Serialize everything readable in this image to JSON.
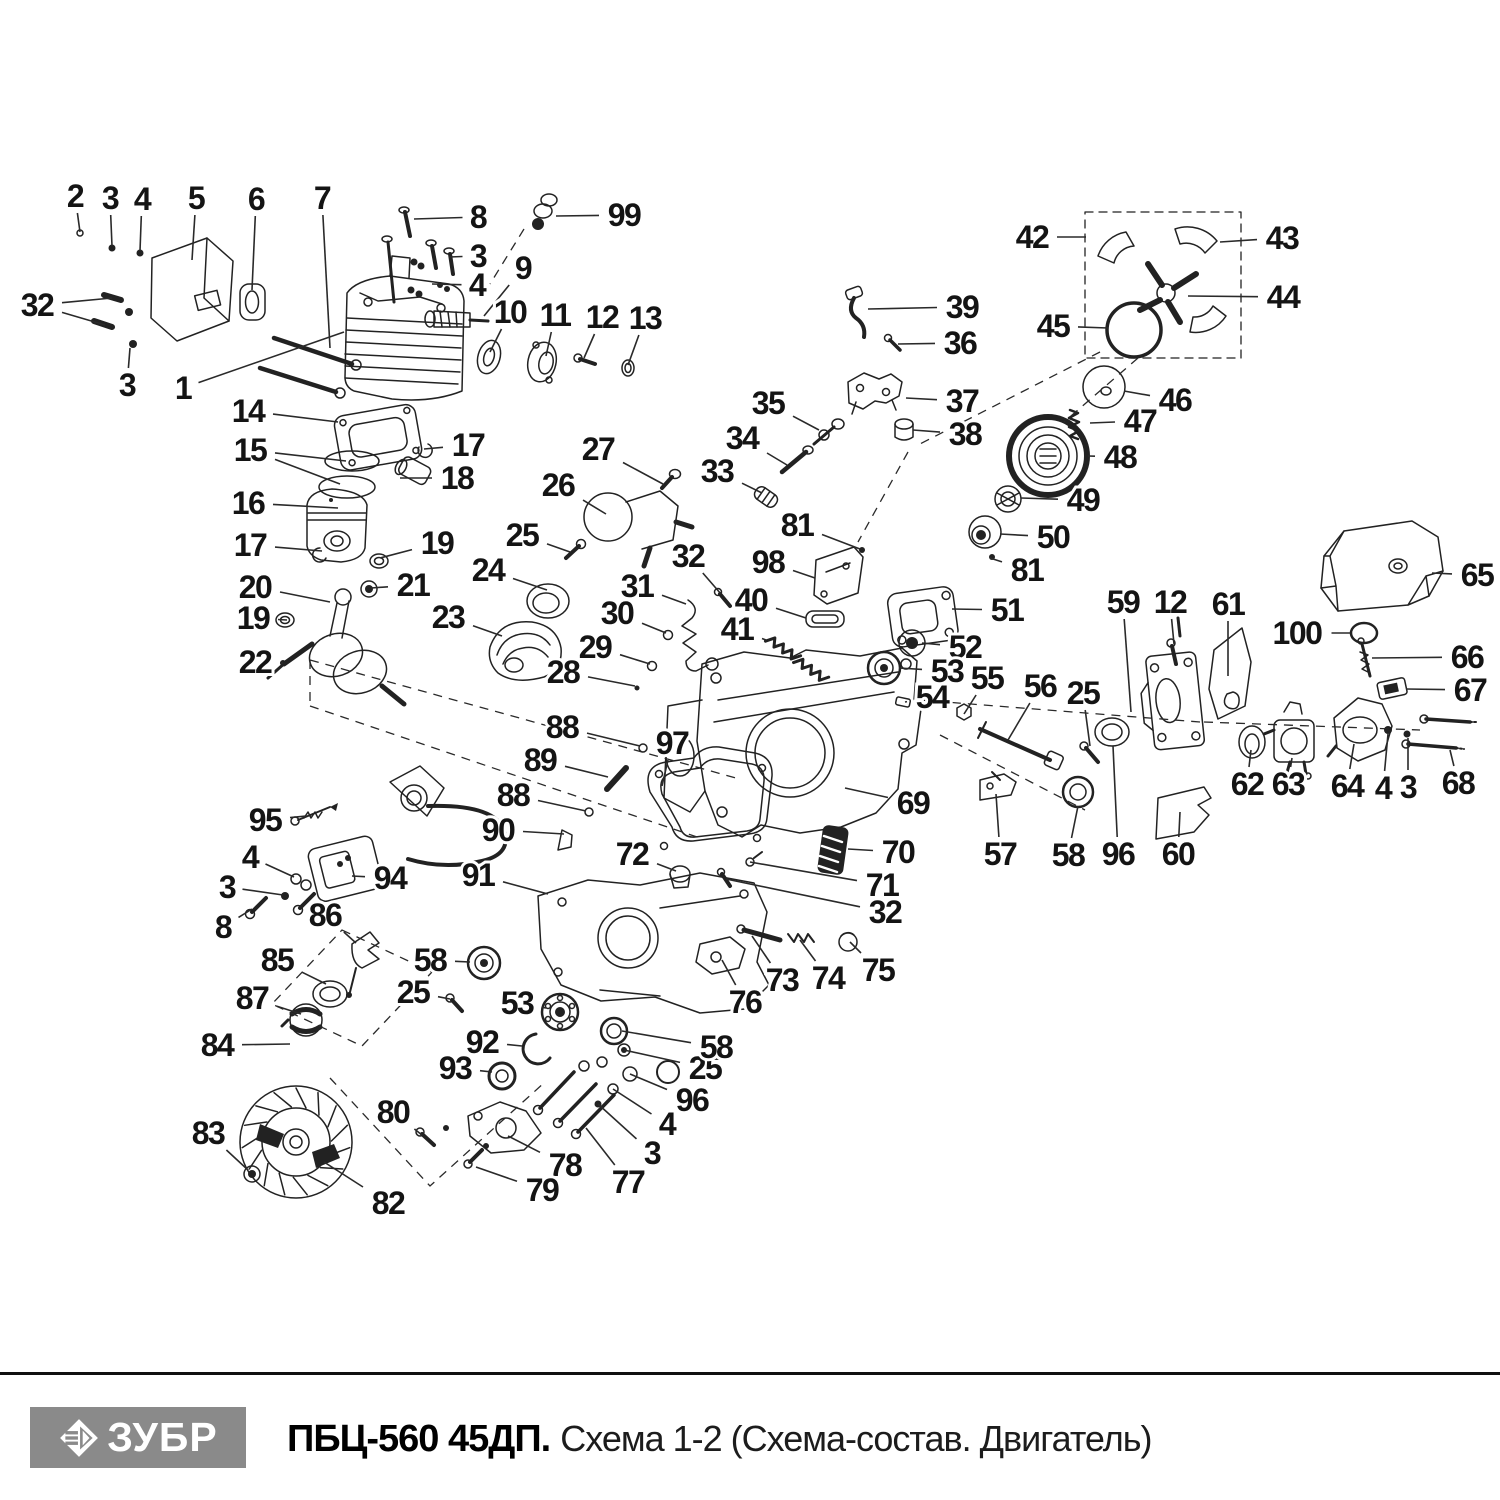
{
  "footer": {
    "brand": "ЗУБР",
    "title_bold": "ПБЦ-560 45ДП.",
    "title_regular": "Схема 1-2 (Схема-состав. Двигатель)",
    "brand_bg": "#8a8a8a",
    "rule_color": "#101010"
  },
  "diagram": {
    "ink": "#222222",
    "labels": [
      {
        "t": "2",
        "x": 75,
        "y": 196,
        "to": [
          [
            80,
            232
          ]
        ]
      },
      {
        "t": "3",
        "x": 110,
        "y": 198,
        "to": [
          [
            112,
            246
          ]
        ]
      },
      {
        "t": "4",
        "x": 142,
        "y": 199,
        "to": [
          [
            140,
            251
          ]
        ]
      },
      {
        "t": "5",
        "x": 196,
        "y": 198,
        "to": [
          [
            192,
            260
          ]
        ]
      },
      {
        "t": "6",
        "x": 256,
        "y": 199,
        "to": [
          [
            252,
            290
          ]
        ]
      },
      {
        "t": "7",
        "x": 322,
        "y": 198,
        "to": [
          [
            330,
            348
          ]
        ]
      },
      {
        "t": "8",
        "x": 478,
        "y": 217,
        "to": [
          [
            414,
            219
          ]
        ]
      },
      {
        "t": "99",
        "x": 624,
        "y": 215,
        "to": [
          [
            556,
            216
          ]
        ]
      },
      {
        "t": "3",
        "x": 478,
        "y": 256,
        "to": [
          [
            449,
            257
          ]
        ]
      },
      {
        "t": "4",
        "x": 477,
        "y": 285,
        "to": [
          [
            432,
            284
          ]
        ]
      },
      {
        "t": "9",
        "x": 523,
        "y": 268,
        "to": [
          [
            484,
            316
          ]
        ]
      },
      {
        "t": "10",
        "x": 510,
        "y": 312,
        "to": [
          [
            490,
            352
          ]
        ]
      },
      {
        "t": "11",
        "x": 555,
        "y": 315,
        "to": [
          [
            546,
            356
          ]
        ]
      },
      {
        "t": "12",
        "x": 602,
        "y": 317,
        "to": [
          [
            584,
            358
          ]
        ]
      },
      {
        "t": "13",
        "x": 645,
        "y": 318,
        "to": [
          [
            628,
            365
          ]
        ]
      },
      {
        "t": "32",
        "x": 37,
        "y": 305,
        "to": [
          [
            112,
            298
          ],
          [
            105,
            325
          ]
        ]
      },
      {
        "t": "3",
        "x": 127,
        "y": 385,
        "to": [
          [
            130,
            348
          ]
        ]
      },
      {
        "t": "1",
        "x": 183,
        "y": 388,
        "to": [
          [
            344,
            332
          ]
        ]
      },
      {
        "t": "14",
        "x": 248,
        "y": 411,
        "to": [
          [
            338,
            422
          ]
        ]
      },
      {
        "t": "15",
        "x": 250,
        "y": 450,
        "to": [
          [
            346,
            461
          ],
          [
            340,
            484
          ]
        ]
      },
      {
        "t": "17",
        "x": 468,
        "y": 445,
        "to": [
          [
            424,
            449
          ]
        ]
      },
      {
        "t": "18",
        "x": 457,
        "y": 478,
        "to": [
          [
            400,
            478
          ]
        ]
      },
      {
        "t": "16",
        "x": 248,
        "y": 503,
        "to": [
          [
            338,
            508
          ]
        ]
      },
      {
        "t": "17",
        "x": 250,
        "y": 545,
        "to": [
          [
            322,
            551
          ]
        ]
      },
      {
        "t": "19",
        "x": 437,
        "y": 543,
        "to": [
          [
            380,
            558
          ]
        ]
      },
      {
        "t": "20",
        "x": 255,
        "y": 587,
        "to": [
          [
            330,
            602
          ]
        ]
      },
      {
        "t": "21",
        "x": 413,
        "y": 585,
        "to": [
          [
            371,
            588
          ]
        ]
      },
      {
        "t": "19",
        "x": 253,
        "y": 618,
        "to": [
          [
            287,
            620
          ]
        ]
      },
      {
        "t": "22",
        "x": 255,
        "y": 662,
        "to": [
          [
            283,
            663
          ]
        ]
      },
      {
        "t": "23",
        "x": 448,
        "y": 617,
        "to": [
          [
            502,
            636
          ]
        ]
      },
      {
        "t": "24",
        "x": 488,
        "y": 570,
        "to": [
          [
            547,
            590
          ]
        ]
      },
      {
        "t": "25",
        "x": 522,
        "y": 535,
        "to": [
          [
            570,
            552
          ]
        ]
      },
      {
        "t": "26",
        "x": 558,
        "y": 485,
        "to": [
          [
            606,
            514
          ]
        ]
      },
      {
        "t": "27",
        "x": 598,
        "y": 449,
        "to": [
          [
            663,
            484
          ]
        ]
      },
      {
        "t": "28",
        "x": 563,
        "y": 672,
        "to": [
          [
            635,
            686
          ]
        ]
      },
      {
        "t": "29",
        "x": 595,
        "y": 647,
        "to": [
          [
            650,
            664
          ]
        ]
      },
      {
        "t": "30",
        "x": 617,
        "y": 613,
        "to": [
          [
            666,
            633
          ]
        ]
      },
      {
        "t": "31",
        "x": 637,
        "y": 586,
        "to": [
          [
            686,
            604
          ]
        ]
      },
      {
        "t": "32",
        "x": 688,
        "y": 556,
        "to": [
          [
            721,
            594
          ]
        ]
      },
      {
        "t": "33",
        "x": 717,
        "y": 471,
        "to": [
          [
            762,
            493
          ]
        ]
      },
      {
        "t": "34",
        "x": 742,
        "y": 438,
        "to": [
          [
            787,
            465
          ]
        ]
      },
      {
        "t": "35",
        "x": 768,
        "y": 403,
        "to": [
          [
            819,
            430
          ]
        ]
      },
      {
        "t": "36",
        "x": 960,
        "y": 343,
        "to": [
          [
            898,
            344
          ]
        ]
      },
      {
        "t": "37",
        "x": 962,
        "y": 401,
        "to": [
          [
            906,
            398
          ]
        ]
      },
      {
        "t": "38",
        "x": 965,
        "y": 434,
        "to": [
          [
            913,
            430
          ]
        ]
      },
      {
        "t": "39",
        "x": 962,
        "y": 307,
        "to": [
          [
            868,
            309
          ]
        ]
      },
      {
        "t": "40",
        "x": 751,
        "y": 600,
        "to": [
          [
            806,
            618
          ]
        ]
      },
      {
        "t": "41",
        "x": 737,
        "y": 629,
        "to": [
          [
            766,
            640
          ]
        ]
      },
      {
        "t": "42",
        "x": 1032,
        "y": 237,
        "to": [
          [
            1086,
            237
          ]
        ]
      },
      {
        "t": "43",
        "x": 1282,
        "y": 238,
        "to": [
          [
            1220,
            242
          ]
        ]
      },
      {
        "t": "44",
        "x": 1283,
        "y": 297,
        "to": [
          [
            1188,
            296
          ]
        ]
      },
      {
        "t": "45",
        "x": 1053,
        "y": 326,
        "to": [
          [
            1108,
            328
          ]
        ]
      },
      {
        "t": "46",
        "x": 1175,
        "y": 400,
        "to": [
          [
            1124,
            391
          ]
        ]
      },
      {
        "t": "47",
        "x": 1140,
        "y": 421,
        "to": [
          [
            1090,
            423
          ]
        ]
      },
      {
        "t": "48",
        "x": 1120,
        "y": 457,
        "to": [
          [
            1088,
            456
          ]
        ]
      },
      {
        "t": "49",
        "x": 1083,
        "y": 500,
        "to": [
          [
            1021,
            498
          ]
        ]
      },
      {
        "t": "50",
        "x": 1053,
        "y": 537,
        "to": [
          [
            1000,
            534
          ]
        ]
      },
      {
        "t": "81",
        "x": 797,
        "y": 525,
        "to": [
          [
            860,
            549
          ]
        ]
      },
      {
        "t": "81",
        "x": 1027,
        "y": 570,
        "to": [
          [
            990,
            558
          ]
        ]
      },
      {
        "t": "98",
        "x": 768,
        "y": 562,
        "to": [
          [
            815,
            578
          ]
        ]
      },
      {
        "t": "51",
        "x": 1007,
        "y": 610,
        "to": [
          [
            952,
            609
          ]
        ]
      },
      {
        "t": "52",
        "x": 965,
        "y": 647,
        "to": [
          [
            922,
            643
          ]
        ]
      },
      {
        "t": "53",
        "x": 947,
        "y": 671,
        "to": [
          [
            899,
            668
          ]
        ]
      },
      {
        "t": "54",
        "x": 932,
        "y": 697,
        "to": [
          [
            905,
            702
          ]
        ]
      },
      {
        "t": "55",
        "x": 987,
        "y": 678,
        "to": [
          [
            964,
            714
          ]
        ]
      },
      {
        "t": "56",
        "x": 1040,
        "y": 686,
        "to": [
          [
            1008,
            740
          ]
        ]
      },
      {
        "t": "59",
        "x": 1123,
        "y": 602,
        "to": [
          [
            1131,
            712
          ]
        ]
      },
      {
        "t": "12",
        "x": 1170,
        "y": 602,
        "to": [
          [
            1174,
            644
          ]
        ]
      },
      {
        "t": "61",
        "x": 1228,
        "y": 604,
        "to": [
          [
            1228,
            676
          ]
        ]
      },
      {
        "t": "65",
        "x": 1477,
        "y": 575,
        "to": [
          [
            1432,
            573
          ]
        ]
      },
      {
        "t": "100",
        "x": 1297,
        "y": 633,
        "to": [
          [
            1350,
            633
          ]
        ]
      },
      {
        "t": "66",
        "x": 1467,
        "y": 657,
        "to": [
          [
            1372,
            658
          ]
        ]
      },
      {
        "t": "67",
        "x": 1470,
        "y": 690,
        "to": [
          [
            1406,
            689
          ]
        ]
      },
      {
        "t": "25",
        "x": 1083,
        "y": 693,
        "to": [
          [
            1090,
            746
          ]
        ]
      },
      {
        "t": "62",
        "x": 1247,
        "y": 784,
        "to": [
          [
            1251,
            750
          ]
        ]
      },
      {
        "t": "63",
        "x": 1288,
        "y": 784,
        "to": [
          [
            1292,
            758
          ]
        ]
      },
      {
        "t": "64",
        "x": 1347,
        "y": 786,
        "to": [
          [
            1354,
            744
          ]
        ]
      },
      {
        "t": "4",
        "x": 1383,
        "y": 788,
        "to": [
          [
            1388,
            734
          ]
        ]
      },
      {
        "t": "3",
        "x": 1408,
        "y": 787,
        "to": [
          [
            1408,
            738
          ]
        ]
      },
      {
        "t": "68",
        "x": 1458,
        "y": 783,
        "to": [
          [
            1450,
            750
          ]
        ]
      },
      {
        "t": "57",
        "x": 1000,
        "y": 854,
        "to": [
          [
            996,
            794
          ]
        ]
      },
      {
        "t": "58",
        "x": 1068,
        "y": 855,
        "to": [
          [
            1078,
            806
          ]
        ]
      },
      {
        "t": "96",
        "x": 1118,
        "y": 854,
        "to": [
          [
            1113,
            746
          ]
        ]
      },
      {
        "t": "60",
        "x": 1178,
        "y": 854,
        "to": [
          [
            1180,
            812
          ]
        ]
      },
      {
        "t": "69",
        "x": 913,
        "y": 803,
        "to": [
          [
            845,
            788
          ]
        ]
      },
      {
        "t": "70",
        "x": 898,
        "y": 852,
        "to": [
          [
            848,
            849
          ]
        ]
      },
      {
        "t": "71",
        "x": 882,
        "y": 885,
        "to": [
          [
            750,
            862
          ]
        ]
      },
      {
        "t": "32",
        "x": 885,
        "y": 912,
        "to": [
          [
            726,
            879
          ]
        ]
      },
      {
        "t": "72",
        "x": 632,
        "y": 854,
        "to": [
          [
            676,
            871
          ]
        ]
      },
      {
        "t": "88",
        "x": 562,
        "y": 727,
        "to": [
          [
            640,
            746
          ]
        ]
      },
      {
        "t": "97",
        "x": 672,
        "y": 743,
        "to": [
          [
            662,
            786
          ]
        ]
      },
      {
        "t": "89",
        "x": 540,
        "y": 760,
        "to": [
          [
            608,
            777
          ]
        ]
      },
      {
        "t": "88",
        "x": 513,
        "y": 795,
        "to": [
          [
            586,
            811
          ]
        ]
      },
      {
        "t": "90",
        "x": 498,
        "y": 830,
        "to": [
          [
            564,
            834
          ]
        ]
      },
      {
        "t": "95",
        "x": 265,
        "y": 820,
        "to": [
          [
            306,
            816
          ]
        ]
      },
      {
        "t": "4",
        "x": 250,
        "y": 857,
        "to": [
          [
            294,
            877
          ]
        ]
      },
      {
        "t": "3",
        "x": 227,
        "y": 887,
        "to": [
          [
            283,
            895
          ]
        ]
      },
      {
        "t": "8",
        "x": 223,
        "y": 927,
        "to": [
          [
            252,
            909
          ]
        ]
      },
      {
        "t": "94",
        "x": 390,
        "y": 878,
        "to": [
          [
            352,
            876
          ]
        ]
      },
      {
        "t": "86",
        "x": 325,
        "y": 915,
        "to": [
          [
            356,
            943
          ]
        ]
      },
      {
        "t": "85",
        "x": 277,
        "y": 960,
        "to": [
          [
            326,
            984
          ]
        ]
      },
      {
        "t": "87",
        "x": 252,
        "y": 998,
        "to": [
          [
            301,
            1014
          ]
        ]
      },
      {
        "t": "84",
        "x": 217,
        "y": 1045,
        "to": [
          [
            290,
            1044
          ]
        ]
      },
      {
        "t": "91",
        "x": 478,
        "y": 875,
        "to": [
          [
            548,
            894
          ]
        ]
      },
      {
        "t": "73",
        "x": 782,
        "y": 980,
        "to": [
          [
            752,
            936
          ]
        ]
      },
      {
        "t": "74",
        "x": 828,
        "y": 978,
        "to": [
          [
            800,
            940
          ]
        ]
      },
      {
        "t": "75",
        "x": 878,
        "y": 970,
        "to": [
          [
            850,
            942
          ]
        ]
      },
      {
        "t": "76",
        "x": 745,
        "y": 1002,
        "to": [
          [
            722,
            960
          ]
        ]
      },
      {
        "t": "58",
        "x": 430,
        "y": 960,
        "to": [
          [
            470,
            962
          ]
        ]
      },
      {
        "t": "25",
        "x": 413,
        "y": 992,
        "to": [
          [
            450,
            999
          ]
        ]
      },
      {
        "t": "53",
        "x": 517,
        "y": 1003,
        "to": [
          [
            546,
            1008
          ]
        ]
      },
      {
        "t": "92",
        "x": 482,
        "y": 1042,
        "to": [
          [
            522,
            1046
          ]
        ]
      },
      {
        "t": "93",
        "x": 455,
        "y": 1068,
        "to": [
          [
            492,
            1072
          ]
        ]
      },
      {
        "t": "80",
        "x": 393,
        "y": 1112,
        "to": [
          [
            422,
            1135
          ]
        ]
      },
      {
        "t": "82",
        "x": 388,
        "y": 1203,
        "to": [
          [
            324,
            1162
          ]
        ]
      },
      {
        "t": "83",
        "x": 208,
        "y": 1133,
        "to": [
          [
            248,
            1170
          ]
        ]
      },
      {
        "t": "78",
        "x": 565,
        "y": 1165,
        "to": [
          [
            508,
            1136
          ]
        ]
      },
      {
        "t": "79",
        "x": 542,
        "y": 1190,
        "to": [
          [
            476,
            1167
          ]
        ]
      },
      {
        "t": "77",
        "x": 628,
        "y": 1182,
        "to": [
          [
            586,
            1128
          ]
        ]
      },
      {
        "t": "3",
        "x": 652,
        "y": 1153,
        "to": [
          [
            598,
            1104
          ]
        ]
      },
      {
        "t": "4",
        "x": 667,
        "y": 1124,
        "to": [
          [
            613,
            1089
          ]
        ]
      },
      {
        "t": "96",
        "x": 692,
        "y": 1100,
        "to": [
          [
            630,
            1074
          ]
        ]
      },
      {
        "t": "25",
        "x": 705,
        "y": 1068,
        "to": [
          [
            624,
            1050
          ]
        ]
      },
      {
        "t": "58",
        "x": 716,
        "y": 1047,
        "to": [
          [
            622,
            1031
          ]
        ]
      }
    ]
  }
}
